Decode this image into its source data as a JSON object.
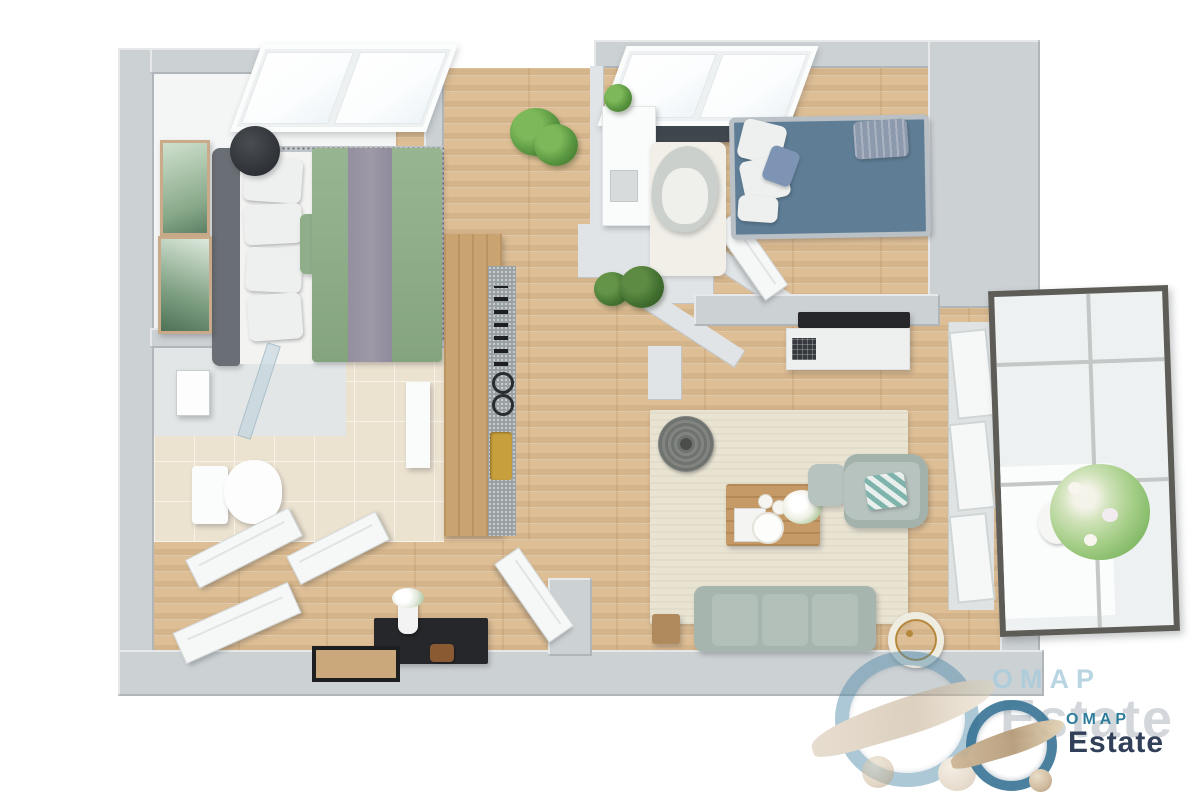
{
  "image_type": "3d-floor-plan-top-view-render",
  "watermark": {
    "large": {
      "line1": "OMAP",
      "line2": "Estate"
    },
    "small": {
      "line1": "OMAP",
      "line2": "Estate"
    }
  },
  "colors": {
    "background": "#ffffff",
    "wall": "#ccd1d4",
    "wall_shadow": "#b4babe",
    "wall_light": "#e0e4e6",
    "floor_wood": "#ddbe95",
    "floor_wood_streak": "#c8a274",
    "floor_white": "#f4f5f5",
    "tile_beige": "#ece2d0",
    "rug_bedroom": "#c0c5c9",
    "bed_headboard": "#6a6f75",
    "bed_sheet": "#f3f3f1",
    "bed_duvet_green": "#8fae89",
    "bed_runner_gray": "#9d99a6",
    "kids_bed_blue": "#5f7e96",
    "kids_bed_frame": "#b9c0c6",
    "pillow_white": "#eef0ef",
    "pillow_gray": "#8d99ad",
    "sofa_green_gray": "#a6b5ae",
    "armchair_gray": "#b7c3be",
    "pillow_teal": "#7fb4ad",
    "rug_living": "#e9e3d2",
    "rug_round": "#6f7370",
    "rug_nursery": "#f1efe8",
    "table_wood": "#c59a67",
    "counter_wood": "#c9a470",
    "countertop_gray": "#9aa1a5",
    "sink_gold": "#c79f3d",
    "plant_green": "#58953f",
    "plant_green_light": "#7db95a",
    "flower_white": "#f5f4ee",
    "balcony_frame": "#5d5c57",
    "glass_pale": "#eef1f1",
    "window_frame_white": "#fbfcfc",
    "dark_sill": "#40474e",
    "console_black": "#26272b",
    "door_white": "#f6f7f7",
    "logo_blue_faded": "#a9cbdc",
    "logo_gray_faded": "#b6bdc5",
    "logo_teal": "#2e7d9c",
    "logo_navy": "#323f58",
    "logo_swoosh_beige": "#cdb697",
    "logo_ring_blue": "#4a86a6"
  },
  "scene": {
    "rooms": [
      {
        "name": "bedroom",
        "items": [
          "skylight-windows",
          "double-bed-green-duvet",
          "headboard",
          "speckled-rug",
          "wall-art-frames",
          "black-chair"
        ]
      },
      {
        "name": "bathroom",
        "items": [
          "walk-in-shower",
          "shower-mixer",
          "glass-panel",
          "toilet",
          "wall-shelf",
          "beige-tile-floor"
        ]
      },
      {
        "name": "entry-hall",
        "items": [
          "open-white-doors",
          "black-console-desk",
          "flower-vase",
          "leaning-picture-frame",
          "bag"
        ]
      },
      {
        "name": "kitchen",
        "items": [
          "counter-with-cooktop",
          "gold-sink"
        ]
      },
      {
        "name": "nursery-nook",
        "items": [
          "white-dresser",
          "egg-armchair",
          "white-rug",
          "potted-plants",
          "dark-window-sill",
          "skylight-windows"
        ]
      },
      {
        "name": "kids-room",
        "items": [
          "blue-daybed",
          "white-pillows",
          "gray-pillow"
        ]
      },
      {
        "name": "living-room",
        "items": [
          "tv",
          "tv-sideboard",
          "beige-area-rug",
          "round-gray-rug",
          "coffee-table",
          "white-flower-bouquet",
          "ottoman",
          "armchair",
          "chevron-pillow",
          "three-seat-sofa",
          "side-table",
          "floor-lamp"
        ]
      },
      {
        "name": "balcony",
        "items": [
          "glazed-metal-frame",
          "flower-planter"
        ]
      }
    ]
  }
}
